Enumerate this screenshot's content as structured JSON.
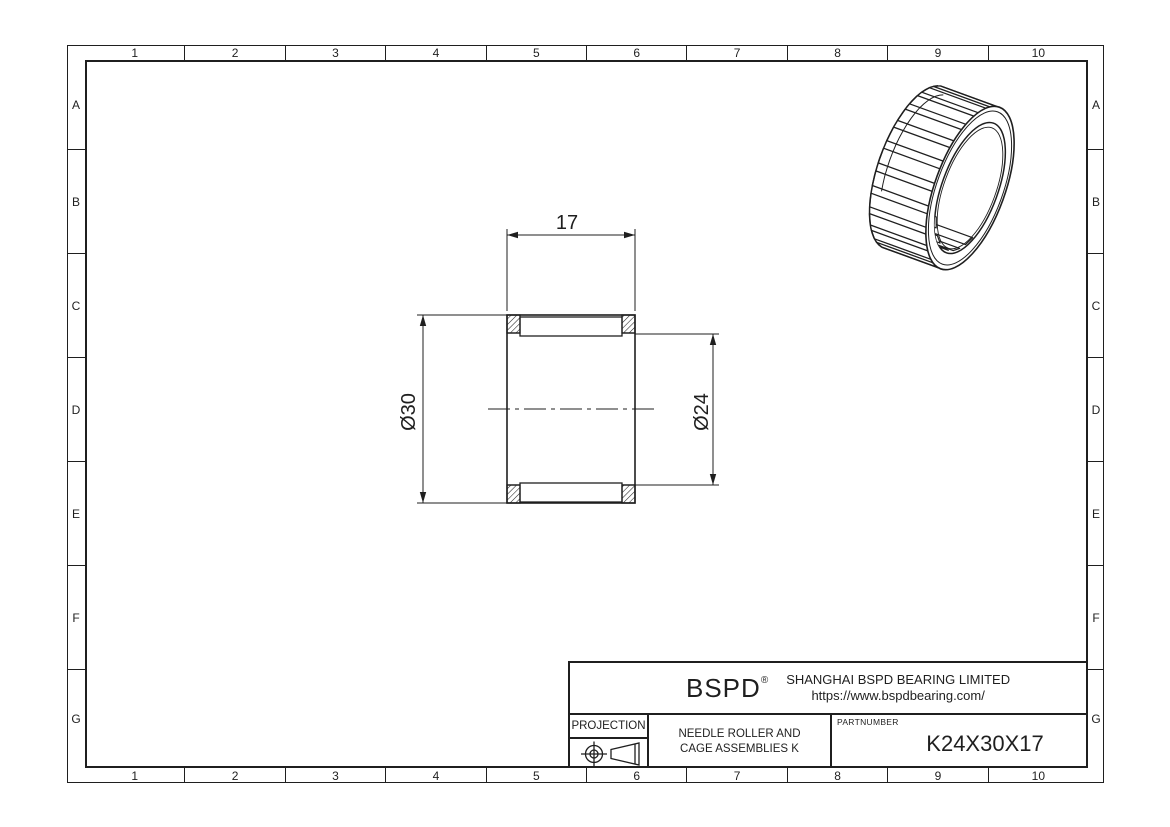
{
  "sheet": {
    "columns": [
      "1",
      "2",
      "3",
      "4",
      "5",
      "6",
      "7",
      "8",
      "9",
      "10"
    ],
    "rows": [
      "A",
      "B",
      "C",
      "D",
      "E",
      "F",
      "G"
    ]
  },
  "drawing": {
    "dim_width": "17",
    "dim_outer_diameter": "Ø30",
    "dim_inner_diameter": "Ø24"
  },
  "title_block": {
    "logo": "BSPD",
    "registered_mark": "®",
    "company": "SHANGHAI BSPD BEARING LIMITED",
    "website": "https://www.bspdbearing.com/",
    "projection_label": "PROJECTION",
    "description_line1": "NEEDLE ROLLER AND",
    "description_line2": "CAGE ASSEMBLIES K",
    "partnumber_label": "PARTNUMBER",
    "partnumber": "K24X30X17"
  },
  "colors": {
    "line": "#1f1f1f",
    "background": "#ffffff"
  }
}
